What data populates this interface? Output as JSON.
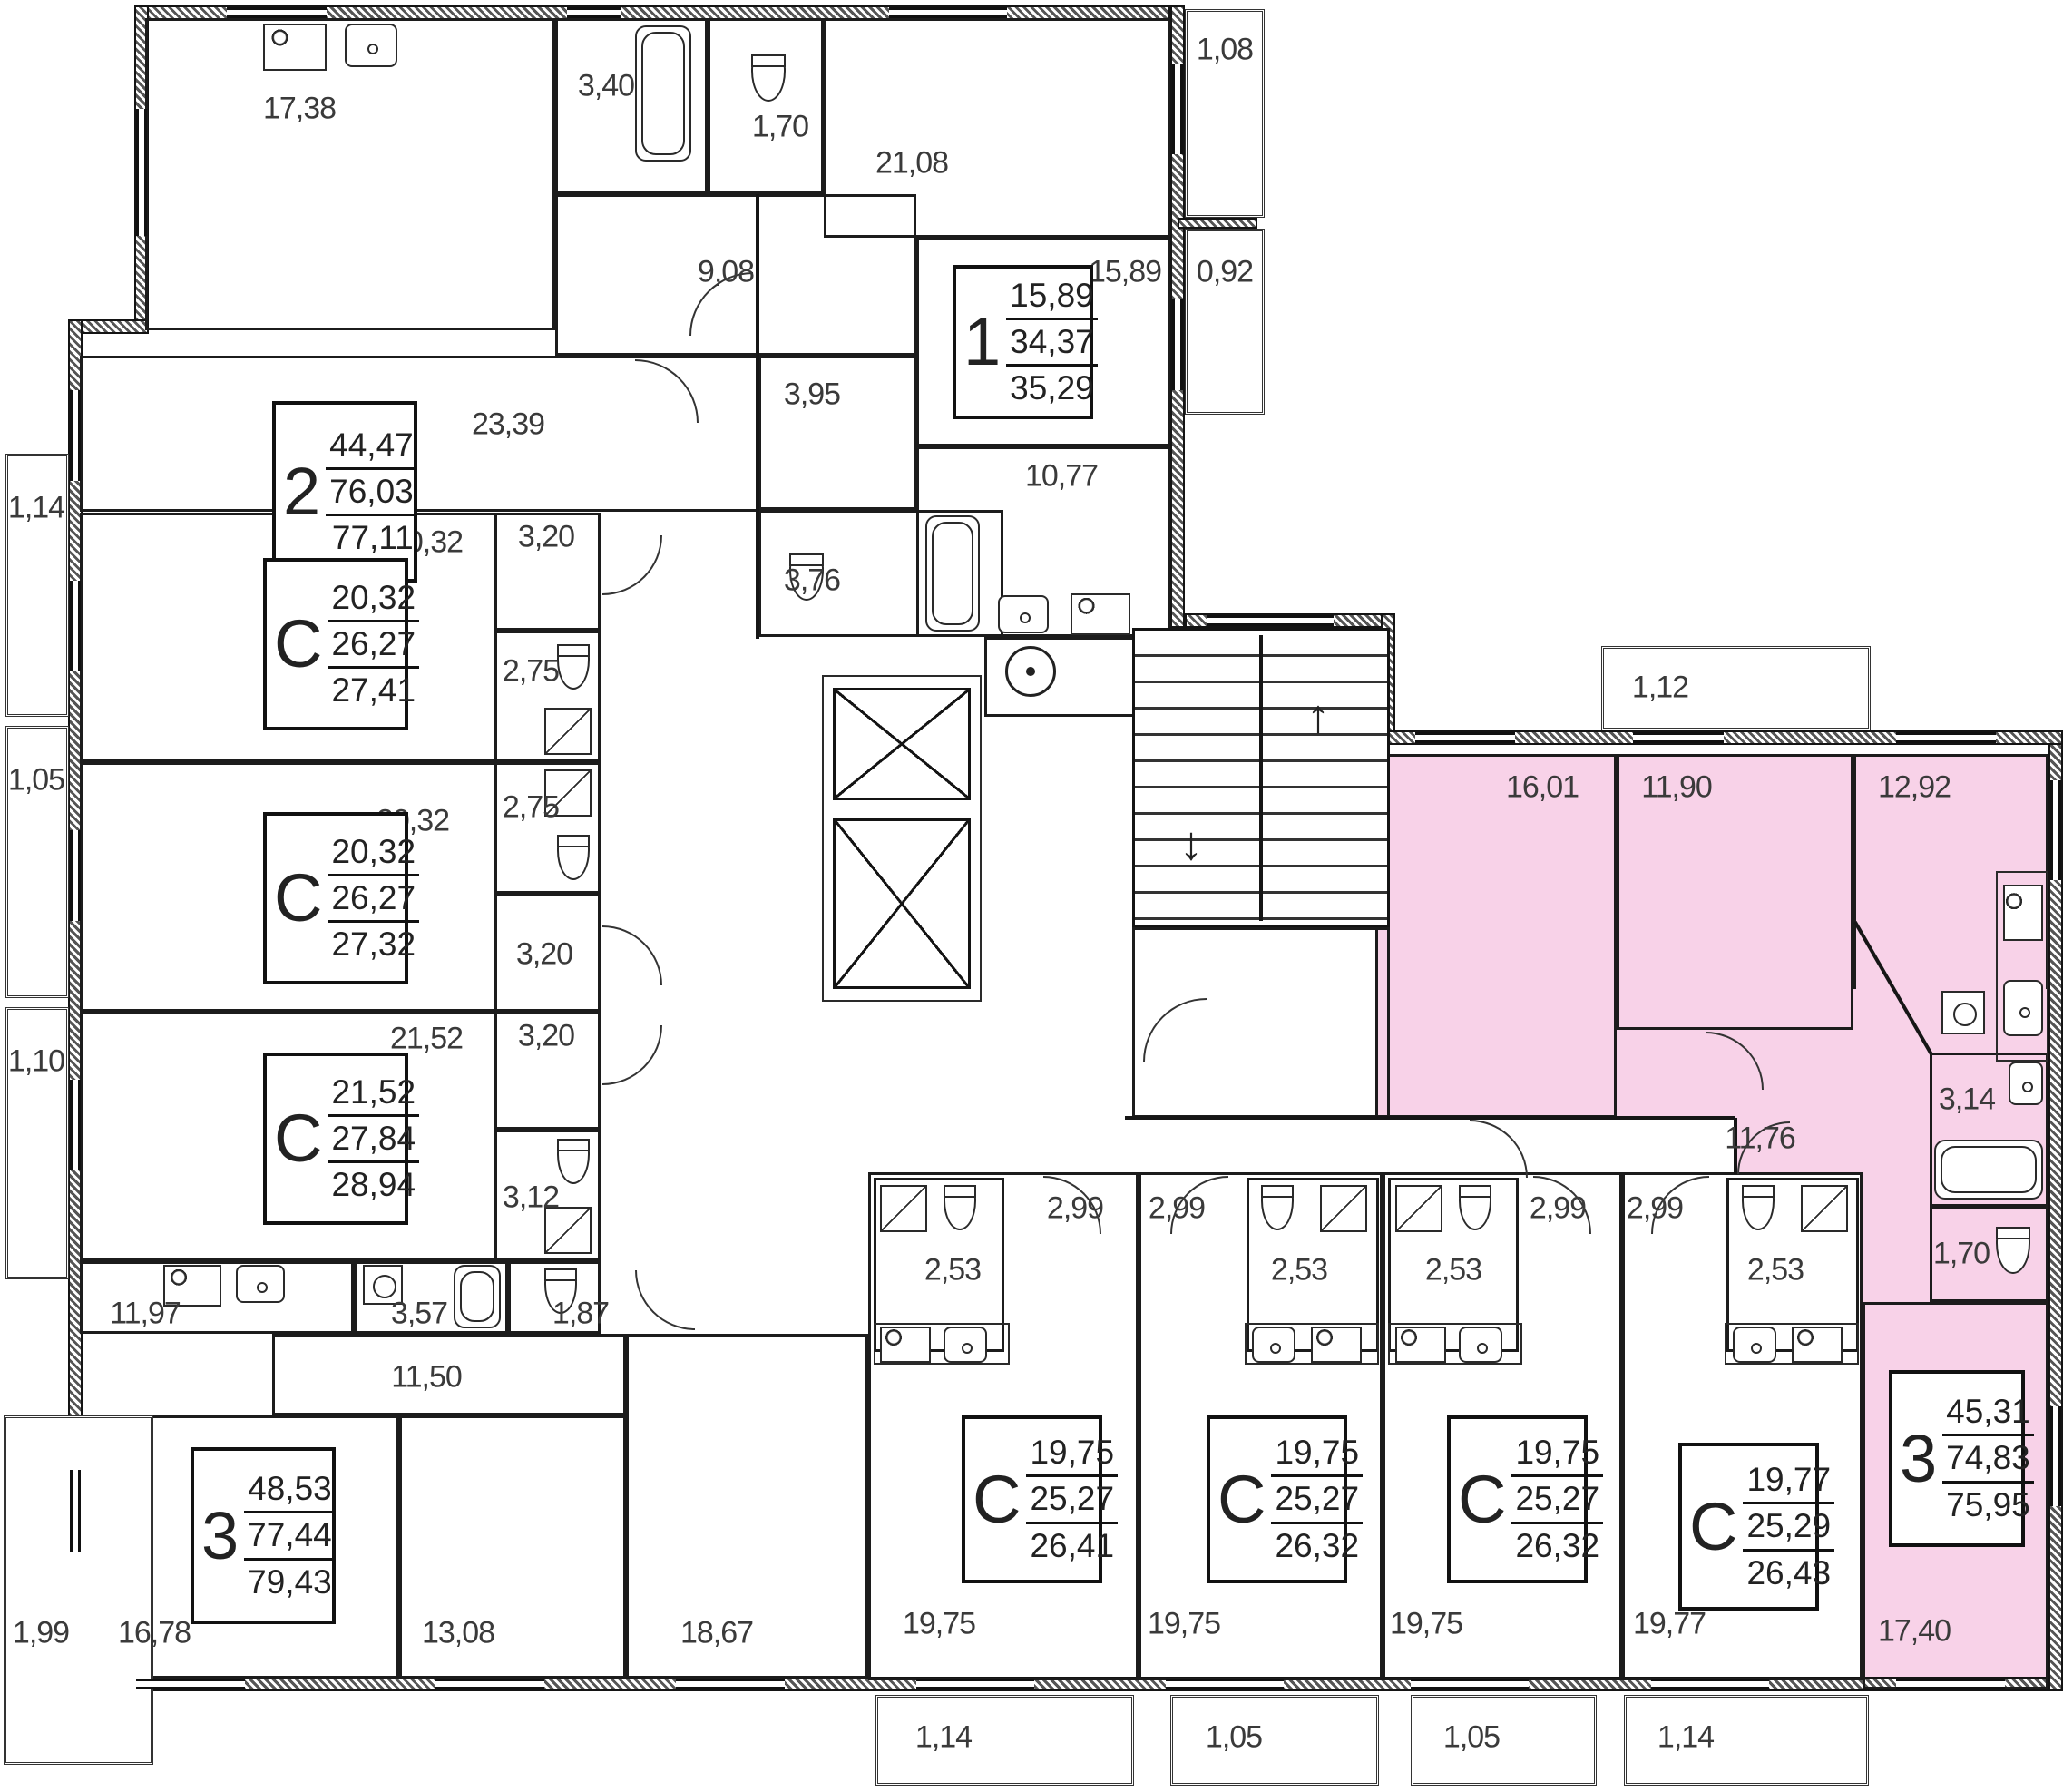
{
  "plan_title": "Residential floor plan",
  "colors": {
    "highlight": "#f8d2e8",
    "wall": "#141414",
    "label": "#3a3a3a"
  },
  "units": [
    {
      "id": "apt-2room-top-left",
      "type_label": "2",
      "area_living": "44,47",
      "area_main": "76,03",
      "area_total": "77,11"
    },
    {
      "id": "apt-1room-top-right",
      "type_label": "1",
      "area_living": "15,89",
      "area_main": "34,37",
      "area_total": "35,29"
    },
    {
      "id": "studio-left-1",
      "type_label": "С",
      "area_living": "20,32",
      "area_main": "26,27",
      "area_total": "27,41"
    },
    {
      "id": "studio-left-2",
      "type_label": "С",
      "area_living": "20,32",
      "area_main": "26,27",
      "area_total": "27,32"
    },
    {
      "id": "studio-left-3",
      "type_label": "С",
      "area_living": "21,52",
      "area_main": "27,84",
      "area_total": "28,94"
    },
    {
      "id": "apt-3room-bottom-left",
      "type_label": "3",
      "area_living": "48,53",
      "area_main": "77,44",
      "area_total": "79,43"
    },
    {
      "id": "studio-bottom-1",
      "type_label": "С",
      "area_living": "19,75",
      "area_main": "25,27",
      "area_total": "26,41"
    },
    {
      "id": "studio-bottom-2",
      "type_label": "С",
      "area_living": "19,75",
      "area_main": "25,27",
      "area_total": "26,32"
    },
    {
      "id": "studio-bottom-3",
      "type_label": "С",
      "area_living": "19,75",
      "area_main": "25,27",
      "area_total": "26,32"
    },
    {
      "id": "studio-bottom-4",
      "type_label": "С",
      "area_living": "19,77",
      "area_main": "25,29",
      "area_total": "26,43"
    },
    {
      "id": "apt-3room-highlighted",
      "type_label": "3",
      "area_living": "45,31",
      "area_main": "74,83",
      "area_total": "75,95"
    }
  ],
  "areas": {
    "apt2_kitchen": "17,38",
    "apt2_bath": "3,40",
    "apt2_wc": "1,70",
    "apt2_hall": "9,08",
    "apt2_living": "23,39",
    "apt1_room": "21,08",
    "apt1_bedroom": "15,89",
    "apt1_kitchen": "10,77",
    "apt1_hall": "3,95",
    "apt1_bath": "3,76",
    "balc_top_right_1": "1,08",
    "balc_top_right_2": "0,92",
    "c1_room": "20,32",
    "c1_hall": "3,20",
    "c1_bath": "2,75",
    "c2_room": "20,32",
    "c2_bath": "2,75",
    "c2_hall": "3,20",
    "c3_room": "21,52",
    "c3_hall": "3,20",
    "c3_bath": "3,12",
    "balc_left_1": "1,14",
    "balc_left_2": "1,05",
    "balc_left_3": "1,10",
    "apt3_kitchen": "11,97",
    "apt3_bath": "3,57",
    "apt3_wc": "1,87",
    "apt3_hall": "11,50",
    "apt3_room1": "16,78",
    "apt3_room2": "13,08",
    "apt3_room3": "18,67",
    "balc_apt3": "1,99",
    "s1_room": "19,75",
    "s1_bath": "2,53",
    "s1_hall": "2,99",
    "s2_room": "19,75",
    "s2_bath": "2,53",
    "s2_hall": "2,99",
    "s3_room": "19,75",
    "s3_bath": "2,53",
    "s3_hall": "2,99",
    "s4_room": "19,77",
    "s4_bath": "2,53",
    "s4_hall": "2,99",
    "balc_bottom_1": "1,14",
    "balc_bottom_2": "1,05",
    "balc_bottom_3": "1,05",
    "balc_bottom_4": "1,14",
    "hl_room1": "16,01",
    "hl_room2": "11,90",
    "hl_kitchen": "12,92",
    "hl_hall": "11,76",
    "hl_bath": "3,14",
    "hl_wc": "1,70",
    "hl_room3": "17,40",
    "balc_hl": "1,12"
  }
}
